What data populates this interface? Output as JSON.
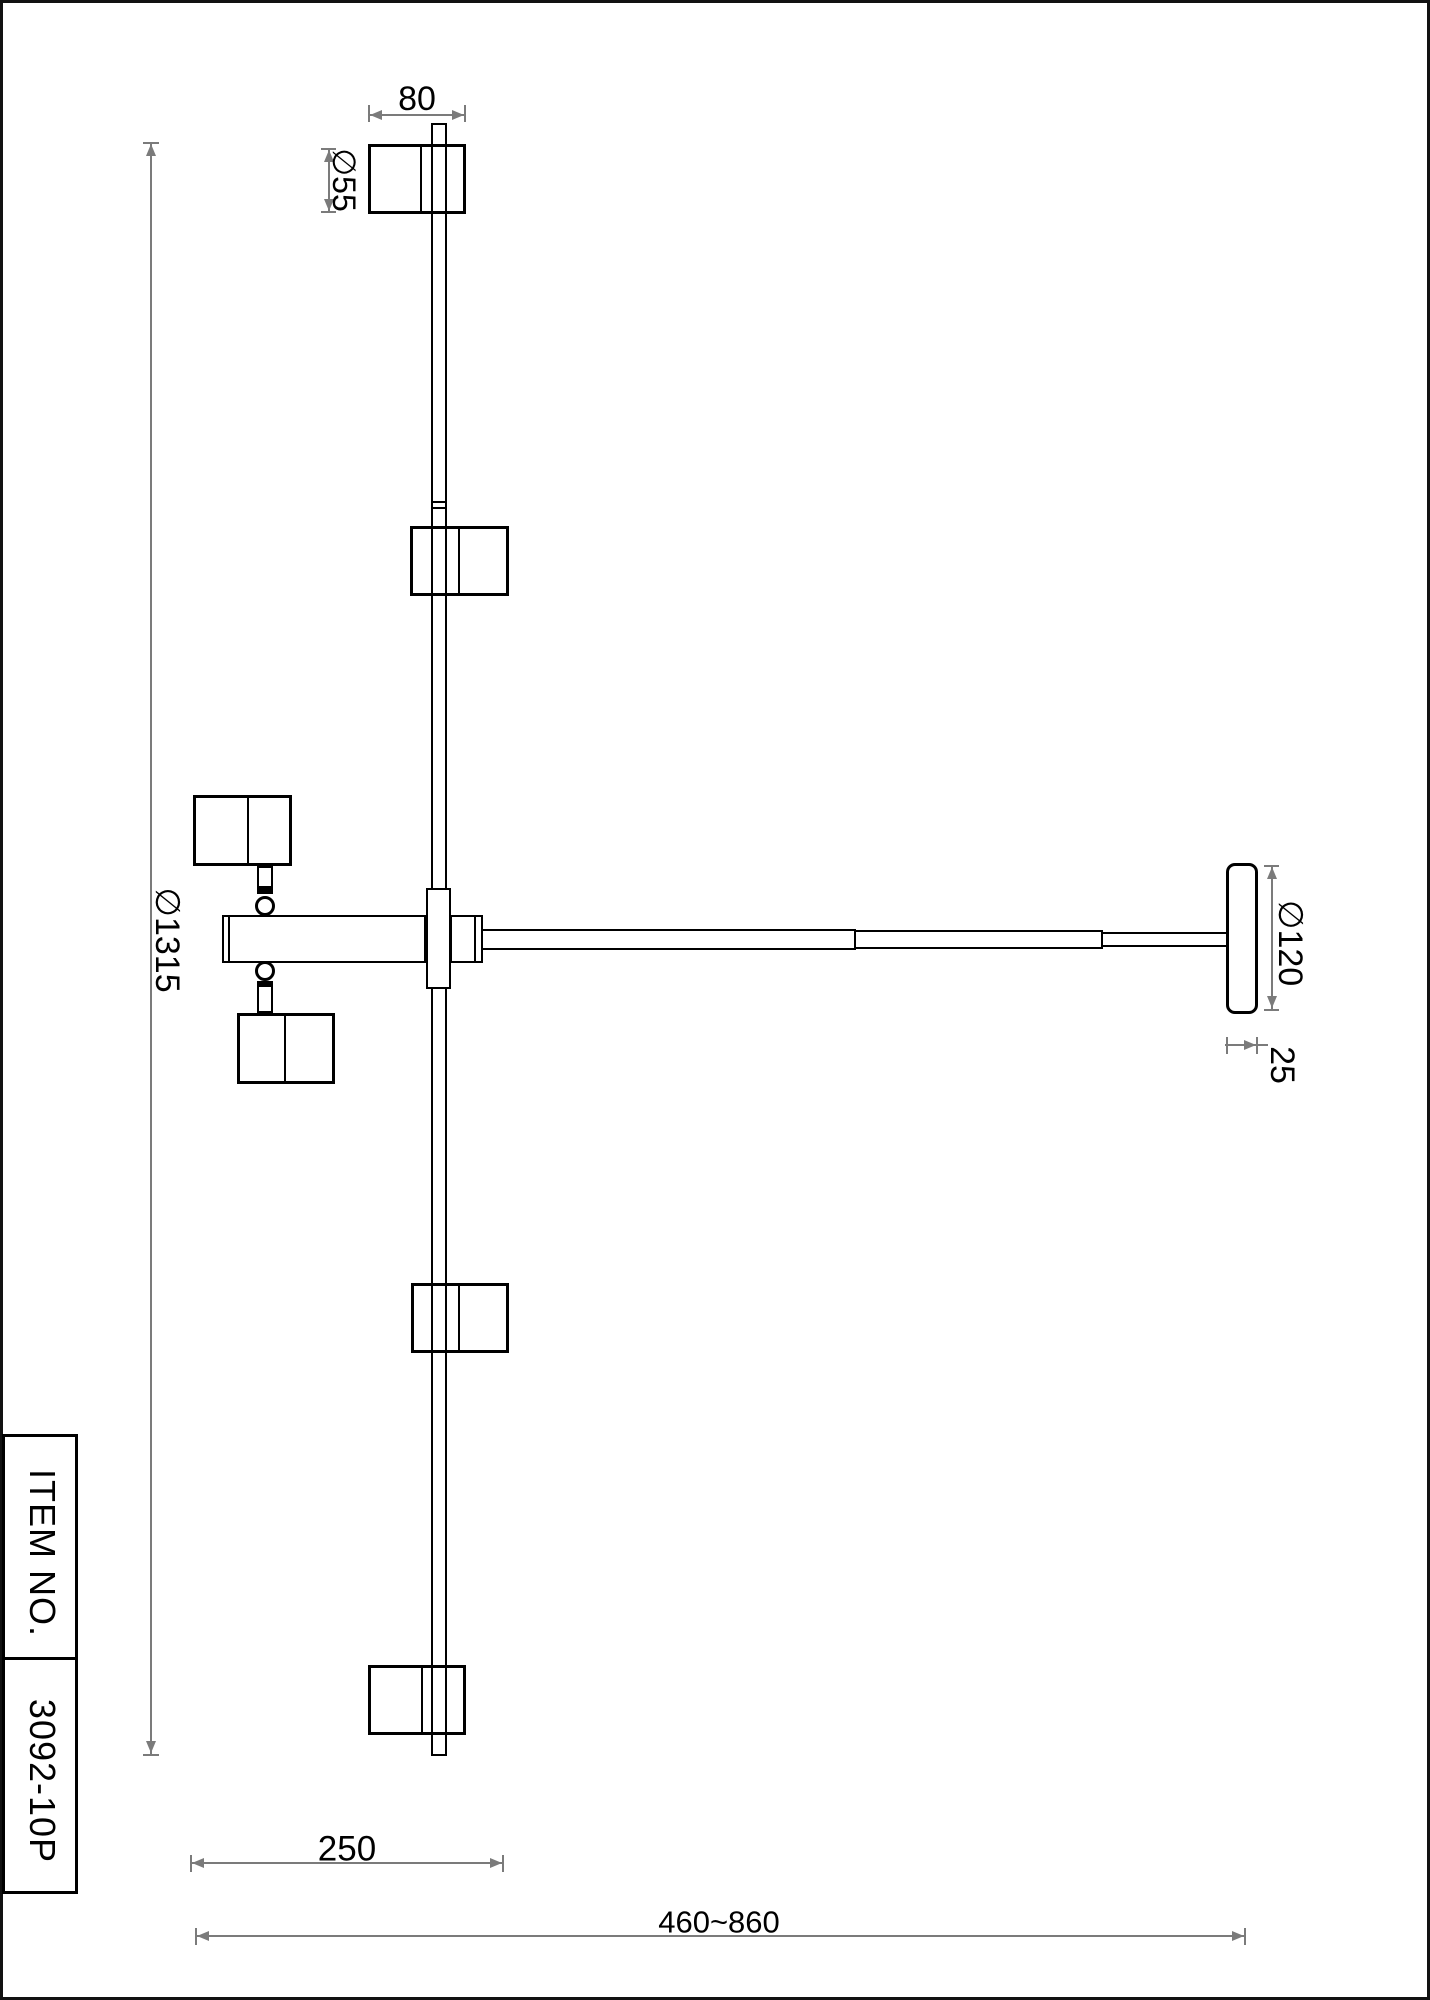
{
  "dimensions": {
    "head_width": "80",
    "head_diameter": "∅55",
    "fixture_diameter": "∅1315",
    "canopy_diameter": "∅120",
    "canopy_thickness": "25",
    "bar_length": "250",
    "rod_length_range": "460~860"
  },
  "title_block": {
    "label": "ITEM NO.",
    "value": "3092-10P"
  },
  "colors": {
    "outline": "#000000",
    "dimension_line": "#7b7b7b",
    "background": "#ffffff"
  }
}
